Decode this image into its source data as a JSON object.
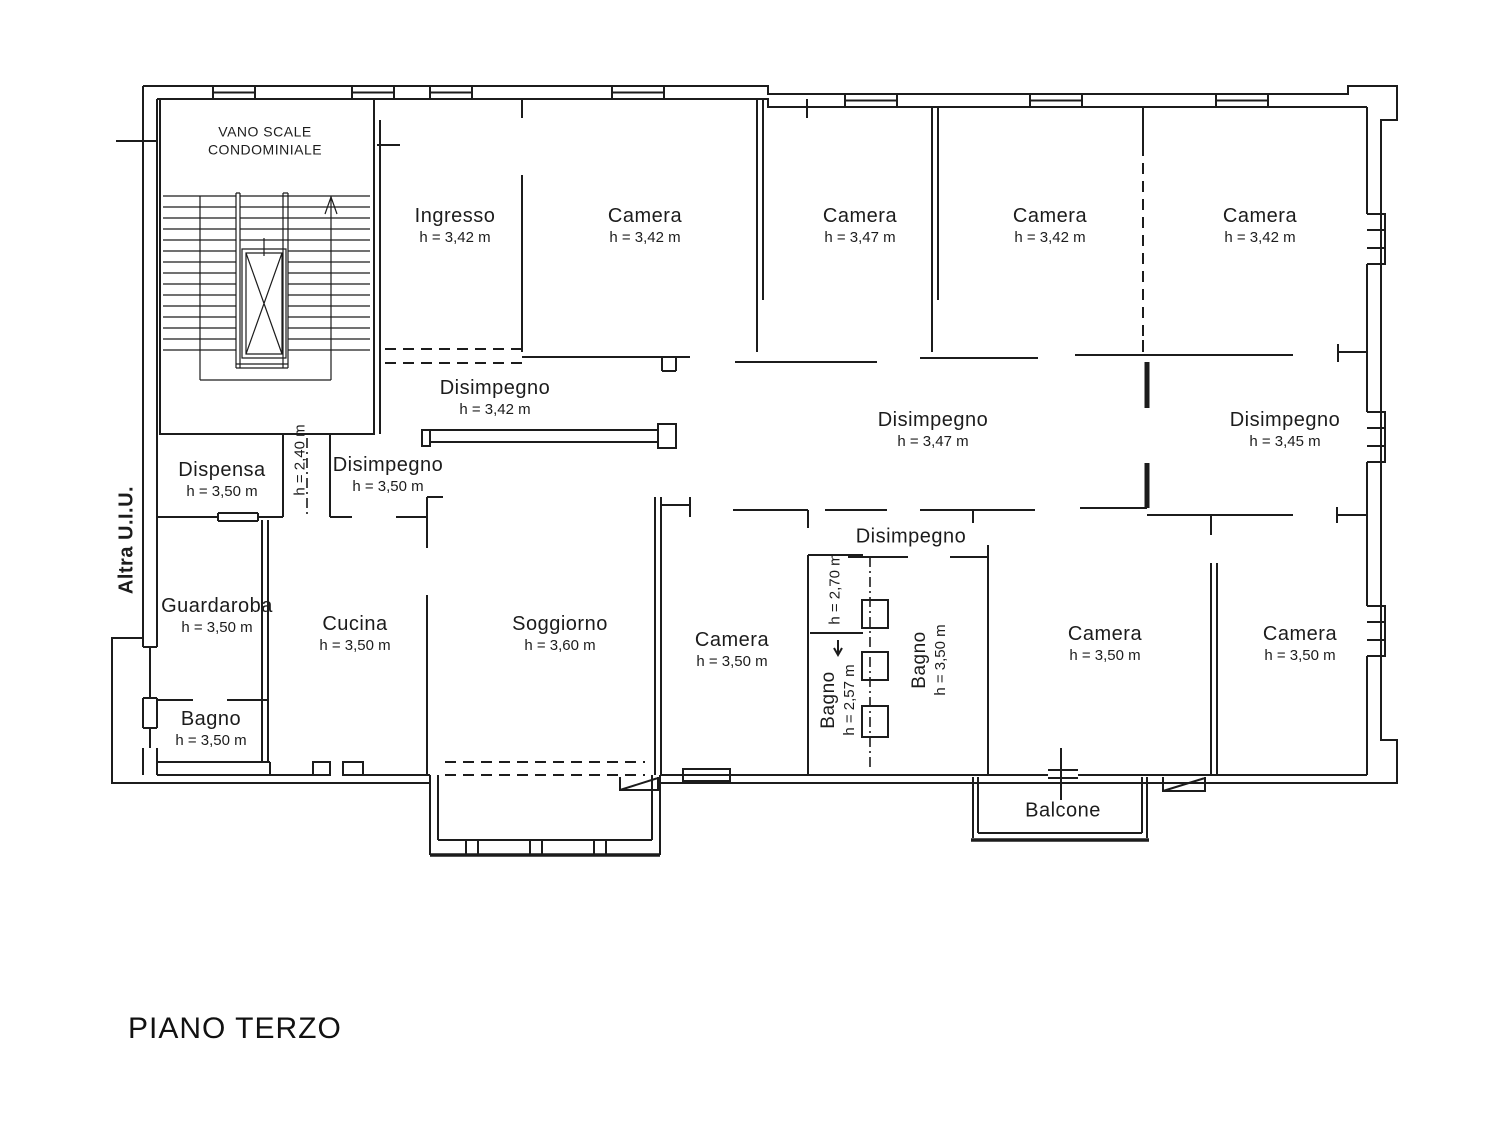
{
  "title": "PIANO TERZO",
  "side_label": "Altra U.I.U.",
  "colors": {
    "line": "#1c1c1c",
    "background": "#ffffff"
  },
  "stairwell": {
    "label_line1": "VANO SCALE",
    "label_line2": "CONDOMINIALE"
  },
  "rooms": {
    "ingresso": {
      "name": "Ingresso",
      "height": "h = 3,42 m"
    },
    "camera1": {
      "name": "Camera",
      "height": "h = 3,42 m"
    },
    "camera2": {
      "name": "Camera",
      "height": "h = 3,47 m"
    },
    "camera3": {
      "name": "Camera",
      "height": "h = 3,42 m"
    },
    "camera4": {
      "name": "Camera",
      "height": "h = 3,42 m"
    },
    "disimpegno_nord": {
      "name": "Disimpegno",
      "height": "h = 3,42 m"
    },
    "disimpegno_centro": {
      "name": "Disimpegno",
      "height": "h = 3,47 m"
    },
    "disimpegno_est": {
      "name": "Disimpegno",
      "height": "h = 3,45 m"
    },
    "dispensa": {
      "name": "Dispensa",
      "height": "h = 3,50 m"
    },
    "corridoio": {
      "height": "h = 2,40 m"
    },
    "disimpegno_ovest": {
      "name": "Disimpegno",
      "height": "h = 3,50 m"
    },
    "guardaroba": {
      "name": "Guardaroba",
      "height": "h = 3,50 m"
    },
    "cucina": {
      "name": "Cucina",
      "height": "h = 3,50 m"
    },
    "soggiorno": {
      "name": "Soggiorno",
      "height": "h = 3,60 m"
    },
    "bagno_ovest": {
      "name": "Bagno",
      "height": "h = 3,50 m"
    },
    "camera_sud1": {
      "name": "Camera",
      "height": "h = 3,50 m"
    },
    "vano270": {
      "height": "h = 2,70 m"
    },
    "bagno_piccolo": {
      "name": "Bagno",
      "height": "h = 2,57 m"
    },
    "disimpegno_sud": {
      "name": "Disimpegno"
    },
    "bagno_grande": {
      "name": "Bagno",
      "height": "h = 3,50 m"
    },
    "camera_sud2": {
      "name": "Camera",
      "height": "h = 3,50 m"
    },
    "camera_sud3": {
      "name": "Camera",
      "height": "h = 3,50 m"
    },
    "balcone": {
      "name": "Balcone"
    }
  }
}
